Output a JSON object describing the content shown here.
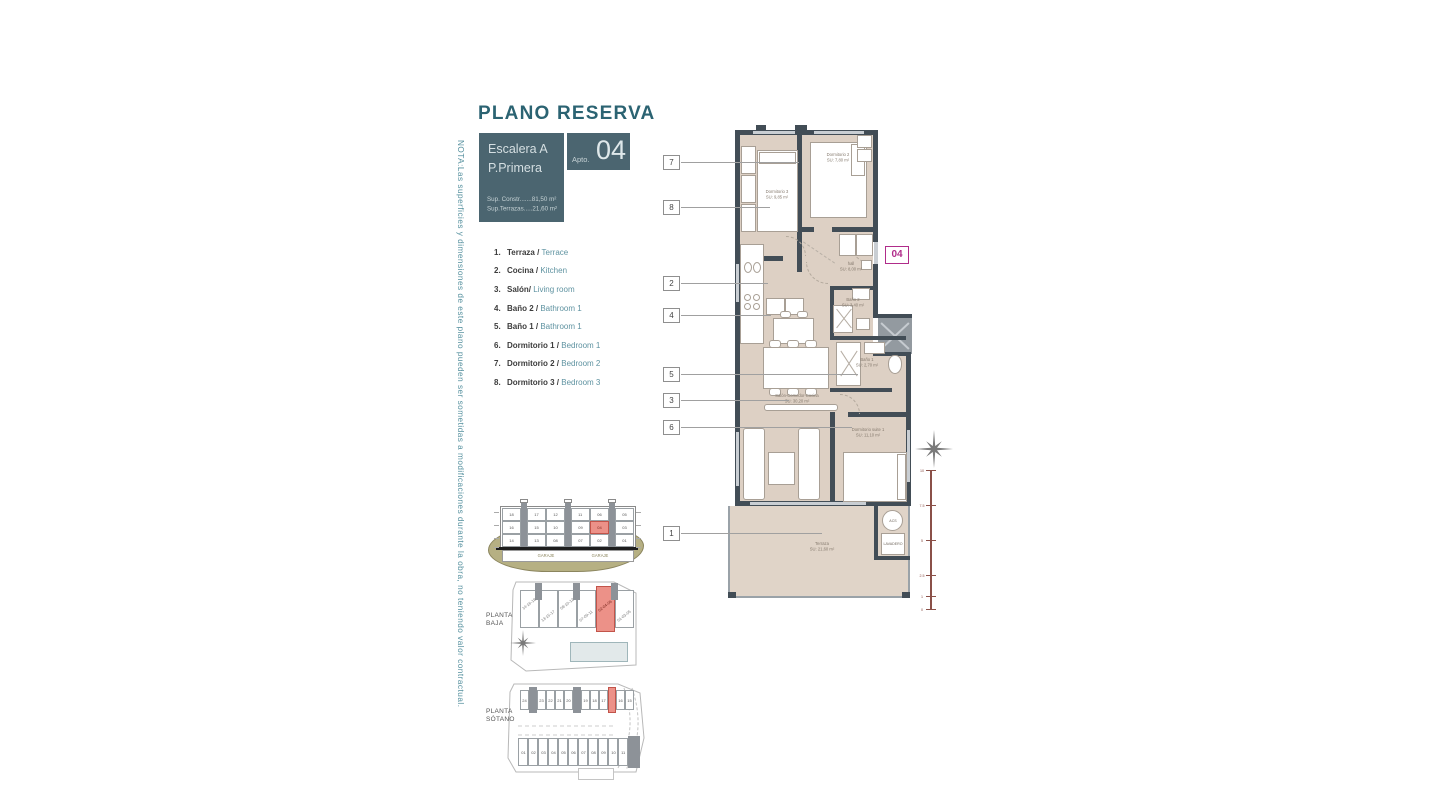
{
  "colors": {
    "teal_dark": "#2b6372",
    "box_teal": "#4b6570",
    "legend_en_teal": "#5f93a1",
    "magenta": "#b02c8a",
    "highlight_red": "#ec9188",
    "wall": "#424d56",
    "floor_beige": "#ddd0c4"
  },
  "header": {
    "title": "PLANO RESERVA",
    "escalera_line1": "Escalera A",
    "escalera_line2": "P.Primera",
    "apto_label": "Apto.",
    "apto_number": "04",
    "sup_constr": "Sup. Constr.......81,50 m²",
    "sup_terrazas": "Sup.Terrazas.....21,60 m²"
  },
  "note": {
    "text": "NOTA:Las superficies y dimensiones de este plano pueden ser sometidas a modificaciones durante la obra, no teniendo valor contractual."
  },
  "legend": [
    {
      "num": "1.",
      "es": "Terraza",
      "sep": " / ",
      "en": "Terrace"
    },
    {
      "num": "2.",
      "es": "Cocina",
      "sep": " / ",
      "en": "Kitchen"
    },
    {
      "num": "3.",
      "es": "Salón/",
      "sep": " ",
      "en": "Living room"
    },
    {
      "num": "4.",
      "es": "Baño 2",
      "sep": " / ",
      "en": "Bathroom 1"
    },
    {
      "num": "5.",
      "es": "Baño 1",
      "sep": " / ",
      "en": "Bathroom 1"
    },
    {
      "num": "6.",
      "es": "Dormitorio 1",
      "sep": " / ",
      "en": "Bedroom 1"
    },
    {
      "num": "7.",
      "es": "Dormitorio 2",
      "sep": " / ",
      "en": "Bedroom 2"
    },
    {
      "num": "8.",
      "es": "Dormitorio 3",
      "sep": " / ",
      "en": "Bedroom 3"
    }
  ],
  "plan": {
    "badge": "04",
    "callouts": [
      "7",
      "8",
      "2",
      "4",
      "5",
      "3",
      "6",
      "1"
    ],
    "rooms": {
      "dorm3": {
        "name": "Dormitorio 3",
        "area": "SU: 9,85 m²"
      },
      "dorm2": {
        "name": "Dormitorio 2",
        "area": "SU: 7,80 m²"
      },
      "hall": {
        "name": "hall",
        "area": "SU: 8,00 m²"
      },
      "bano2": {
        "name": "Baño 2",
        "area": "SU: 3,40 m²"
      },
      "bano1": {
        "name": "Baño 1",
        "area": "SU: 2,70 m²"
      },
      "salon": {
        "name": "Salón-Comedor-Cocina",
        "area": "SU: 30,20 m²"
      },
      "suite": {
        "name": "Dormitorio suite 1",
        "area": "SU: 11,10 m²"
      },
      "terraza": {
        "name": "Terraza",
        "area": "SU: 21,60 m²"
      }
    },
    "annex": {
      "acs": "ACS",
      "lavadero": "LAVADERO"
    },
    "scale_ticks": [
      "10",
      "7.5",
      "5",
      "2.5",
      "1",
      "0"
    ]
  },
  "section": {
    "floors": [
      [
        "18",
        "17",
        "12",
        "11",
        "06",
        "05"
      ],
      [
        "16",
        "15",
        "10",
        "09",
        "04",
        "03"
      ],
      [
        "14",
        "13",
        "08",
        "07",
        "02",
        "01"
      ]
    ],
    "highlight_unit": "04",
    "garage_labels": [
      "GARAJE",
      "GARAJE"
    ]
  },
  "planta_baja": {
    "label1": "PLANTA",
    "label2": "BAJA",
    "units": [
      "14-16-18",
      "13-15-17",
      "08-10-12",
      "07-09-11",
      "02-04-06",
      "01-03-05"
    ],
    "highlight_unit": "02-04-06"
  },
  "planta_sotano": {
    "label1": "PLANTA",
    "label2": "SÓTANO",
    "top_cells": [
      "24",
      "23",
      "22",
      "21",
      "20",
      "19",
      "18",
      "17",
      "16",
      "15"
    ],
    "bottom_cells": [
      "01",
      "02",
      "03",
      "04",
      "05",
      "06",
      "07",
      "08",
      "09",
      "10",
      "11"
    ]
  }
}
